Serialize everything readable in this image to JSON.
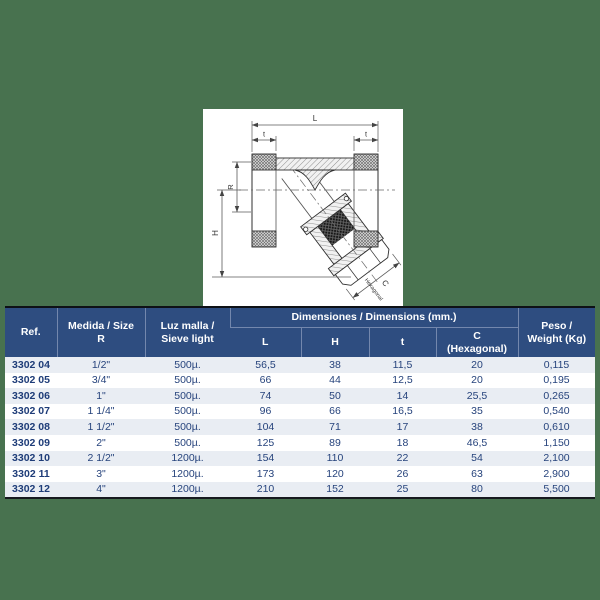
{
  "colors": {
    "background_green": "#48724F",
    "header_navy": "#2E4D80",
    "row_stripe": "#E9EDF3",
    "text_navy": "#26437C"
  },
  "diagram": {
    "labels": {
      "L": "L",
      "t_left": "t",
      "t_right": "t",
      "R": "R",
      "H": "H",
      "C": "C",
      "hexagonal": "Hexagonal"
    }
  },
  "table": {
    "headers": {
      "ref": "Ref.",
      "size_line1": "Medida / Size",
      "size_line2": "R",
      "sieve_line1": "Luz malla /",
      "sieve_line2": "Sieve light",
      "dims_group": "Dimensiones / Dimensions (mm.)",
      "col_l": "L",
      "col_h": "H",
      "col_t": "t",
      "col_c_line1": "C",
      "col_c_line2": "(Hexagonal)",
      "weight_line1": "Peso /",
      "weight_line2": "Weight (Kg)"
    },
    "rows": [
      {
        "ref": "3302 04",
        "size": "1/2\"",
        "sieve": "500µ.",
        "l": "56,5",
        "h": "38",
        "t": "11,5",
        "c": "20",
        "weight": "0,115"
      },
      {
        "ref": "3302 05",
        "size": "3/4\"",
        "sieve": "500µ.",
        "l": "66",
        "h": "44",
        "t": "12,5",
        "c": "20",
        "weight": "0,195"
      },
      {
        "ref": "3302 06",
        "size": "1\"",
        "sieve": "500µ.",
        "l": "74",
        "h": "50",
        "t": "14",
        "c": "25,5",
        "weight": "0,265"
      },
      {
        "ref": "3302 07",
        "size": "1 1/4\"",
        "sieve": "500µ.",
        "l": "96",
        "h": "66",
        "t": "16,5",
        "c": "35",
        "weight": "0,540"
      },
      {
        "ref": "3302 08",
        "size": "1 1/2\"",
        "sieve": "500µ.",
        "l": "104",
        "h": "71",
        "t": "17",
        "c": "38",
        "weight": "0,610"
      },
      {
        "ref": "3302 09",
        "size": "2\"",
        "sieve": "500µ.",
        "l": "125",
        "h": "89",
        "t": "18",
        "c": "46,5",
        "weight": "1,150"
      },
      {
        "ref": "3302 10",
        "size": "2 1/2\"",
        "sieve": "1200µ.",
        "l": "154",
        "h": "110",
        "t": "22",
        "c": "54",
        "weight": "2,100"
      },
      {
        "ref": "3302 11",
        "size": "3\"",
        "sieve": "1200µ.",
        "l": "173",
        "h": "120",
        "t": "26",
        "c": "63",
        "weight": "2,900"
      },
      {
        "ref": "3302 12",
        "size": "4\"",
        "sieve": "1200µ.",
        "l": "210",
        "h": "152",
        "t": "25",
        "c": "80",
        "weight": "5,500"
      }
    ]
  }
}
